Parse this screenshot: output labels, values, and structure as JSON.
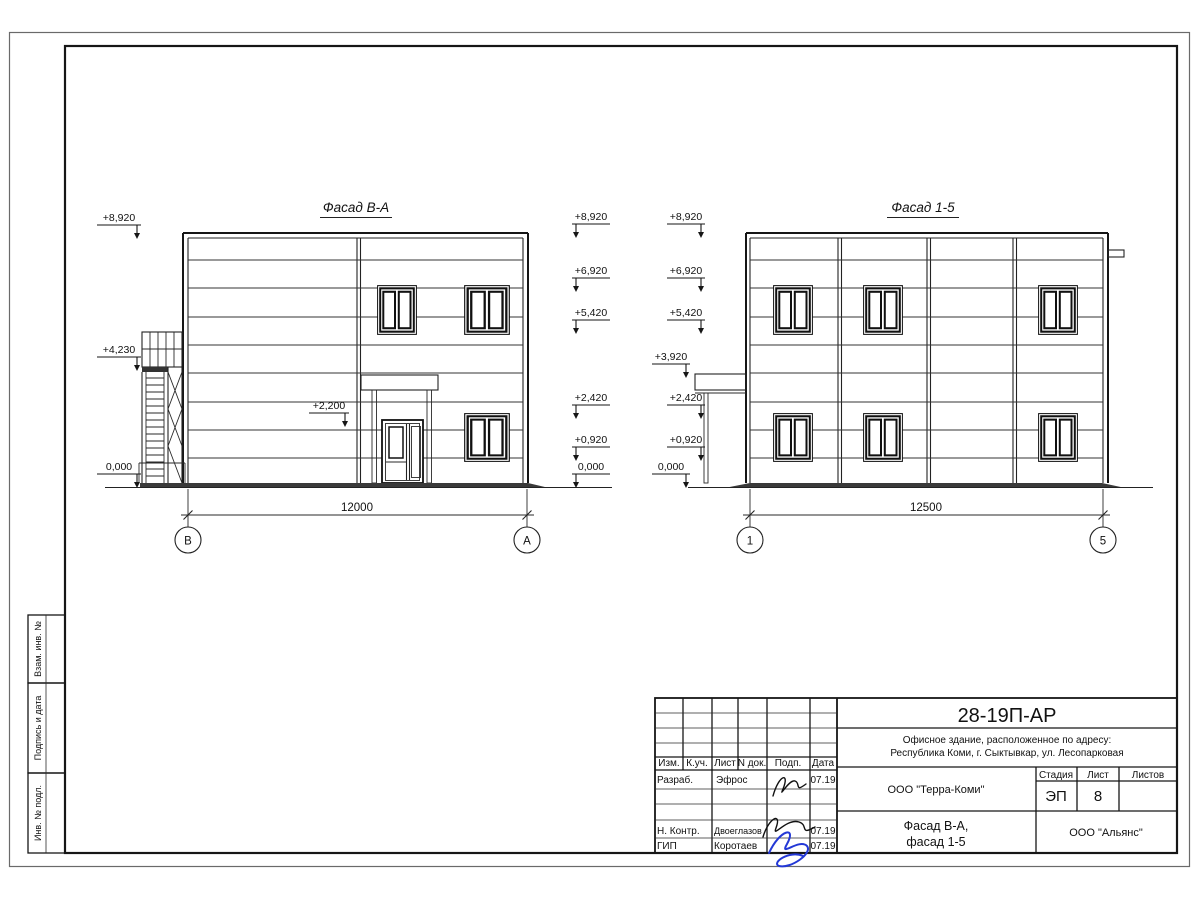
{
  "frame": {
    "sidebar": [
      "Взам. инв. №",
      "Подпись и дата",
      "Инв. № подл."
    ]
  },
  "facade_ba": {
    "title": "Фасад В-А",
    "marks_far_left": [
      "+8,920",
      "+4,230",
      "0,000"
    ],
    "mark_door": "+2,200",
    "marks_right": [
      "+8,920",
      "+6,920",
      "+5,420",
      "+2,420",
      "+0,920",
      "0,000"
    ],
    "dimension": "12000",
    "axis_left": "В",
    "axis_right": "А"
  },
  "facade_15": {
    "title": "Фасад 1-5",
    "marks_left": [
      "+8,920",
      "+6,920",
      "+5,420",
      "+3,920",
      "+2,420",
      "+0,920",
      "0,000"
    ],
    "dimension": "12500",
    "axis_left": "1",
    "axis_right": "5"
  },
  "titleblock": {
    "doc_number": "28-19П-АР",
    "address_line1": "Офисное здание, расположенное по адресу:",
    "address_line2": "Республика Коми, г. Сыктывкар, ул. Лесопарковая",
    "header_cols": [
      "Изм.",
      "К.уч.",
      "Лист",
      "N док.",
      "Подп.",
      "Дата"
    ],
    "rows": [
      {
        "role": "Разраб.",
        "name": "Эфрос",
        "date": "07.19"
      },
      {
        "role": "Н. Контр.",
        "name": "Двоеглазов",
        "date": "07.19"
      },
      {
        "role": "ГИП",
        "name": "Коротаев",
        "date": "07.19"
      }
    ],
    "org": "ООО \"Терра-Коми\"",
    "stage_label": "Стадия",
    "stage": "ЭП",
    "sheet_label": "Лист",
    "sheet": "8",
    "sheets_label": "Листов",
    "sheets": "",
    "drawing_title_line1": "Фасад В-А,",
    "drawing_title_line2": "фасад 1-5",
    "contractor": "ООО \"Альянс\""
  }
}
